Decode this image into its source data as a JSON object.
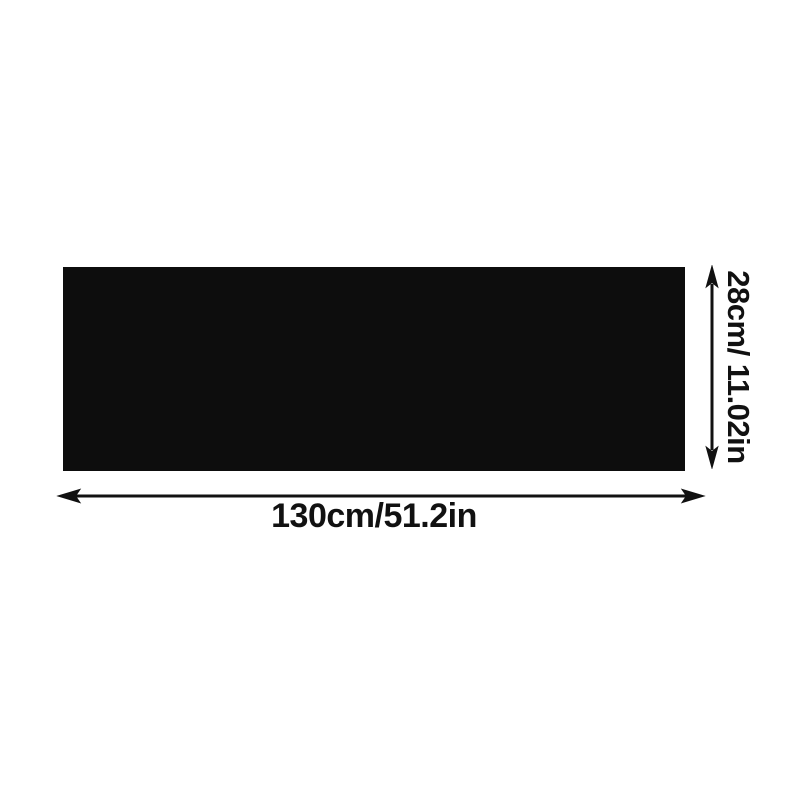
{
  "diagram": {
    "width_label": "130cm/51.2in",
    "height_label": "28cm/ 11.02in",
    "rectangle_color": "#0d0d0d",
    "ink_color": "#111111",
    "background_color": "#ffffff"
  }
}
